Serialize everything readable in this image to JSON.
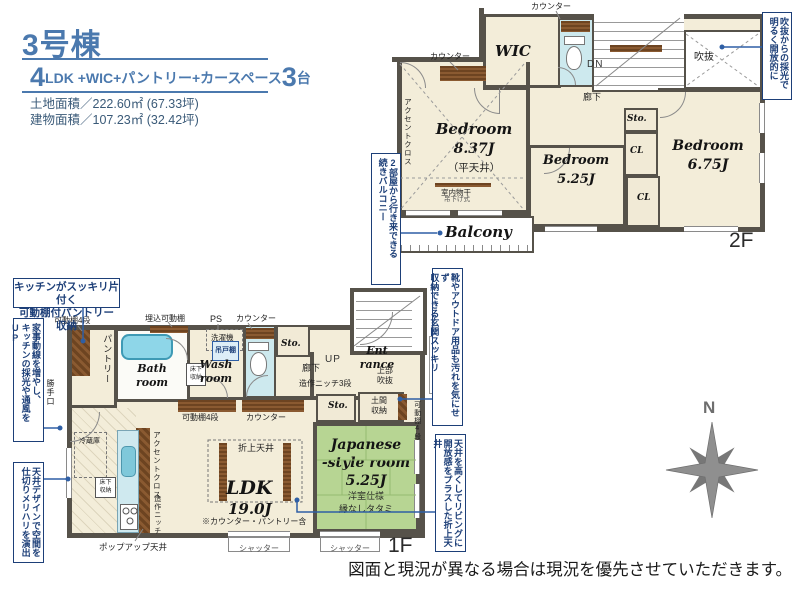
{
  "header": {
    "building_no": "3号棟",
    "layout_num": "4",
    "layout_text": "LDK +WIC+パントリー+カースペース",
    "layout_num2": "3",
    "layout_unit": "台",
    "land_area": "土地面積／222.60㎡ (67.33坪)",
    "building_area": "建物面積／107.23㎡ (32.42坪)"
  },
  "f2": {
    "label": "2F",
    "wic": "WIC",
    "bed1": "Bedroom",
    "bed1_size": "8.37J",
    "bed1_ceiling": "（平天井）",
    "bed2": "Bedroom",
    "bed2_size": "5.25J",
    "bed3": "Bedroom",
    "bed3_size": "6.75J",
    "sto": "Sto.",
    "cl1": "CL",
    "cl2": "CL",
    "balcony": "Balcony",
    "void": "吹抜",
    "hall": "廊下",
    "dn": "DN",
    "counter1": "カウンター",
    "counter2": "カウンター",
    "accent": "アクセントクロス",
    "drying": "室内物干",
    "drying_sub": "吊下げ式",
    "co_void": "吹抜からの採光で\n明るく開放的に",
    "co_balcony": "2部屋から行き来できる\n続きバルコニー"
  },
  "f1": {
    "label": "1F",
    "pantry": "パントリー",
    "shelf4_1": "可動棚4段",
    "backdoor": "勝手口",
    "bath": "Bath\nroom",
    "bath_shelf": "埋込可動棚",
    "washer": "洗濯機",
    "hang_cab": "吊戸棚",
    "wash": "Wash\nroom",
    "ps": "PS",
    "counter_wc": "カウンター",
    "floor_st": "床下\n収納",
    "sto1": "Sto.",
    "sto2": "Sto.",
    "hall": "廊下",
    "up": "UP",
    "niche3": "造作ニッチ3段",
    "entrance": "Ent\nrance",
    "upper_void": "上部\n吹抜",
    "doma": "土間\n収納",
    "shelf4_2": "可動棚4段",
    "shelf4_3": "可動棚4段",
    "counter_ldk": "カウンター",
    "fridge": "冷蔵庫",
    "accent": "アクセントクロス",
    "niche_k": "造作ニッチ",
    "oriage": "折上天井",
    "ldk": "LDK",
    "ldk_size": "19.0J",
    "ldk_note": "※カウンター・パントリー含",
    "jroom": "Japanese\n-style room",
    "jroom_size": "5.25J",
    "jroom_note1": "洋室仕様",
    "jroom_note2": "縁なしタタミ",
    "popup": "ポップアップ天井",
    "shutter": "シャッター",
    "co_pantry": "キッチンがスッキリ片付く\n可動棚付パントリー収納",
    "co_kaji": "家事動線を増やし、\nキッチンの採光や通風をUP",
    "co_genkan": "靴やアウトドア用品も汚れを気にせず\n収納できる玄関スッキリ",
    "co_oriage": "天井を高くしてリビングに\n開放感をプラスした折上天井",
    "co_ceiling": "天井デザインで空間を\n仕切りメリハリを演出"
  },
  "compass": {
    "north": "N"
  },
  "footer": {
    "disclaimer": "図面と現況が異なる場合は現況を優先させていただきます。"
  },
  "colors": {
    "title_blue": "#4b79ae",
    "callout_navy": "#1d3f78",
    "leader_blue": "#2f5fa5",
    "wall_gray": "#56524a",
    "floor_cream": "#f3edd9",
    "tatami_green": "#b7d593",
    "fixture_blue": "#cde9ee",
    "wood_brown": "#7a4f2a",
    "compass_gray": "#8f8f8f"
  }
}
